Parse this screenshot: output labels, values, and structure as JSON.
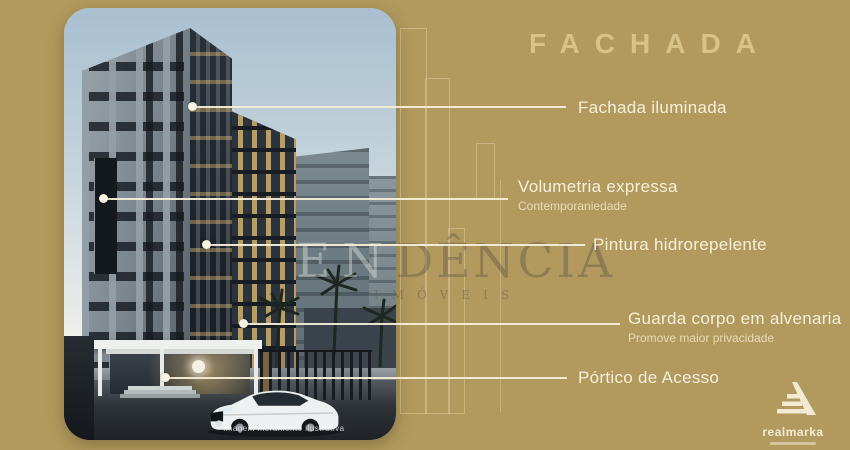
{
  "title": "FACHADA",
  "photo": {
    "caption": "imagem meramente ilustrativa"
  },
  "watermark": {
    "light": "EN",
    "dark": "DÊNCIA",
    "sub": "IMÓVEIS"
  },
  "annotations": [
    {
      "label": "Fachada iluminada",
      "sublabel": ""
    },
    {
      "label": "Volumetria expressa",
      "sublabel": "Contemporaniedade"
    },
    {
      "label": "Pintura hidrorepelente",
      "sublabel": ""
    },
    {
      "label": "Guarda corpo em alvenaria",
      "sublabel": "Promove maior privacidade"
    },
    {
      "label": "Pórtico de Acesso",
      "sublabel": ""
    }
  ],
  "logo": {
    "name": "realmarka"
  },
  "colors": {
    "background": "#b29a5e",
    "title_text": "#d7c28a",
    "label_text": "#f6efdb",
    "leader_line": "#f5eed8",
    "building_dark": "#262d35",
    "window_glow": "#d0ac62",
    "sky_top": "#a9bfd0"
  }
}
